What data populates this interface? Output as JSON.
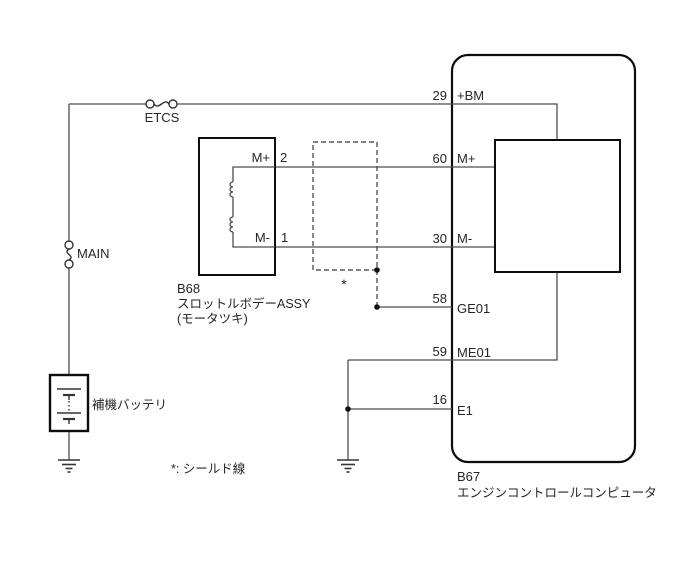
{
  "diagram": {
    "background": "#ffffff",
    "wire_color": "#4d4d4d",
    "box_color": "#0d0d0d",
    "fuses": {
      "etcs": "ETCS",
      "main": "MAIN"
    },
    "battery": {
      "label": "補機バッテリ"
    },
    "throttle_body": {
      "id": "B68",
      "name": "スロットルボデーASSY",
      "sub": "(モータツキ)",
      "pins": [
        {
          "num": "2",
          "label": "M+"
        },
        {
          "num": "1",
          "label": "M-"
        }
      ]
    },
    "ecu": {
      "id": "B67",
      "name": "エンジンコントロールコンピュータ",
      "pins": [
        {
          "num": "29",
          "label": "+BM"
        },
        {
          "num": "60",
          "label": "M+"
        },
        {
          "num": "30",
          "label": "M-"
        },
        {
          "num": "58",
          "label": "GE01"
        },
        {
          "num": "59",
          "label": "ME01"
        },
        {
          "num": "16",
          "label": "E1"
        }
      ]
    },
    "shield": {
      "mark": "*",
      "note": "*: シールド線"
    }
  }
}
